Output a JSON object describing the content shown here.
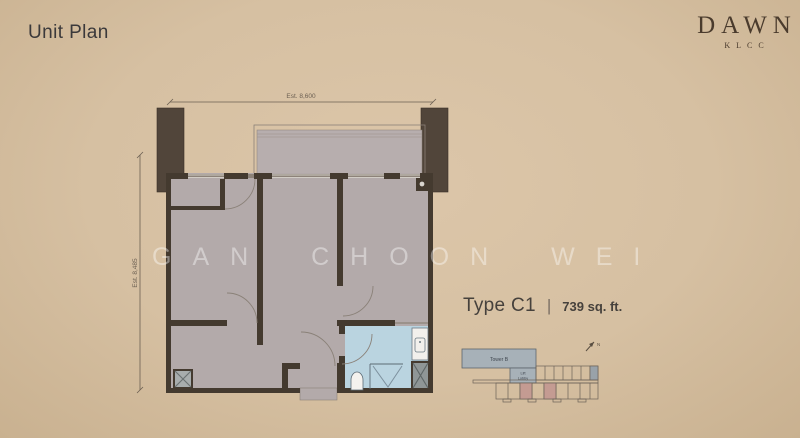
{
  "header": {
    "title": "Unit Plan"
  },
  "logo": {
    "name": "DAWN",
    "subtitle": "KLCC"
  },
  "floorplan": {
    "dim_width": "Est. 8,600",
    "dim_height": "Est. 8,485"
  },
  "watermark": {
    "text": "GAN CHOON WEI"
  },
  "unit_info": {
    "type": "Type C1",
    "separator": "|",
    "area": "739 sq. ft."
  },
  "keyplan": {
    "tower_label": "Tower B",
    "lift_line1": "Lift",
    "lift_line2": "Lobby",
    "north_label": "N"
  },
  "colors": {
    "background": "#d6c0a2",
    "wall": "#443a2f",
    "column": "#51453a",
    "floor": "#b3aaaa",
    "balcony_floor": "#b7aeae",
    "bathroom": "#bad4e0",
    "fixture_stroke": "#5c6b75",
    "keyplan_tower": "#a7b1b8",
    "keyplan_highlight": "#c49b92",
    "dim_color": "#6b5f52",
    "text_dark": "#3b393b",
    "logo_brown": "#4a3b2d"
  }
}
